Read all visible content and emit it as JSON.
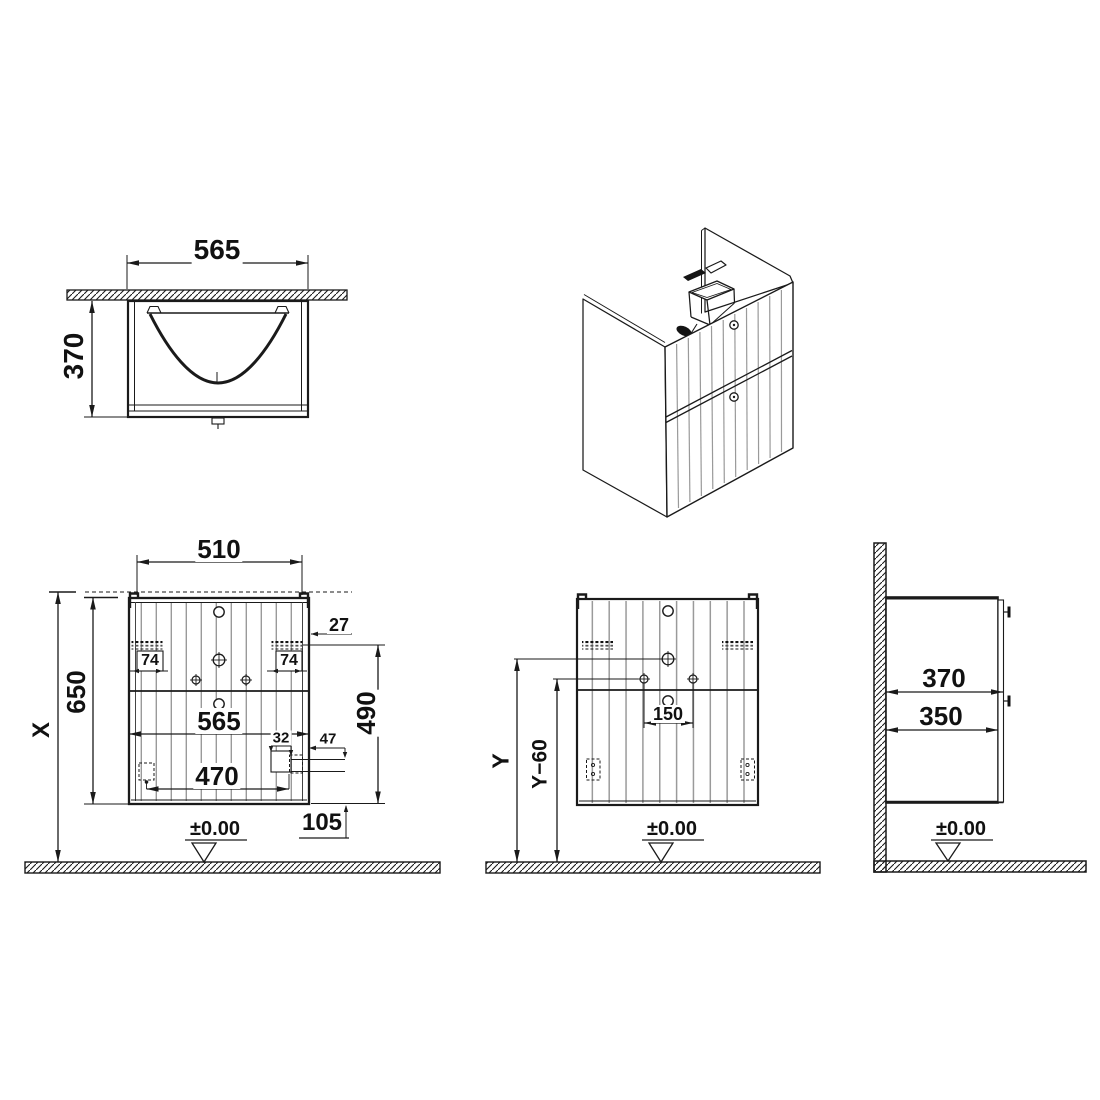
{
  "drawing_type": "technical-furniture-drawing",
  "views": {
    "plan": {
      "width": "565",
      "depth": "370"
    },
    "front": {
      "top_width": "510",
      "total_height": "X",
      "height": "650",
      "bracket_left": "74",
      "bracket_right": "74",
      "edge_offset": "27",
      "width": "565",
      "bracket_height": "490",
      "runner_width": "32",
      "runner_offset": "47",
      "feet_width": "470",
      "bottom_offset": "105",
      "datum": "±0.00"
    },
    "rear": {
      "hole_spacing": "150",
      "mount_height": "Y",
      "tap_height": "Y−60",
      "datum": "±0.00"
    },
    "side": {
      "depth_total": "370",
      "depth_carcass": "350",
      "datum": "±0.00"
    }
  },
  "colors": {
    "line": "#1a1a1a",
    "flute": "#9a9a9a",
    "background": "#ffffff"
  }
}
